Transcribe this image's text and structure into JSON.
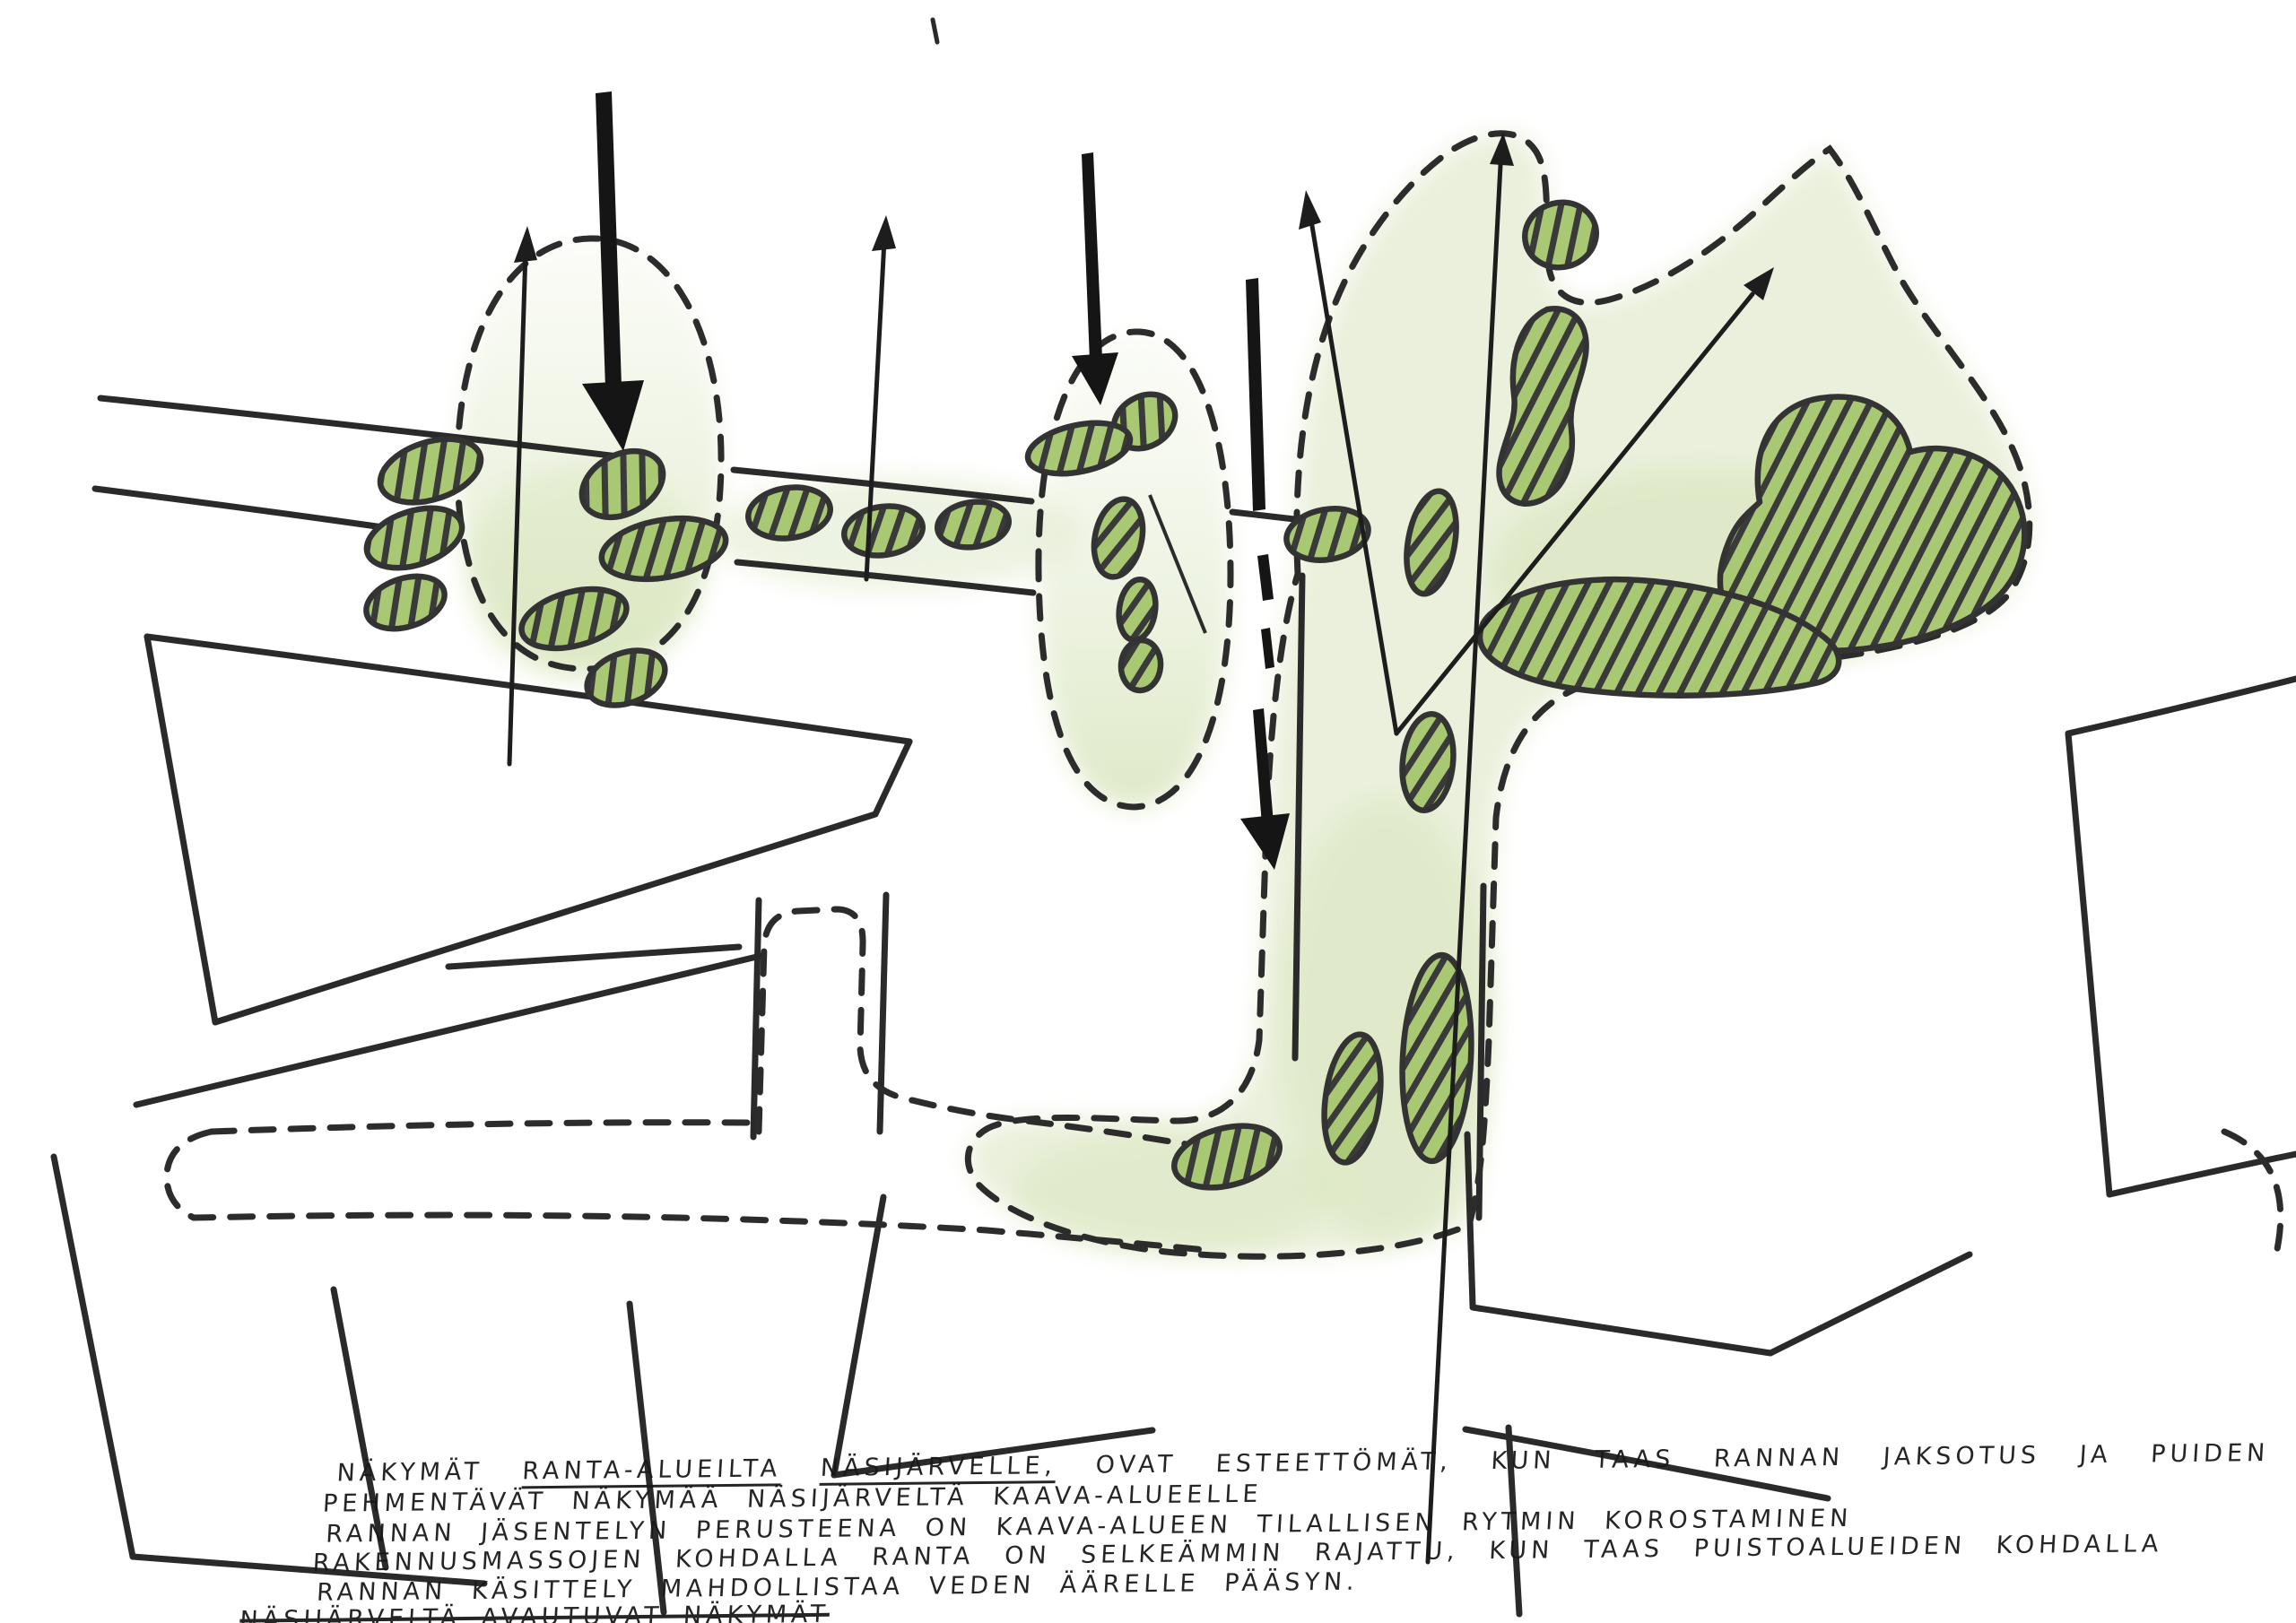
{
  "annotation": {
    "line1": {
      "lead": "NÄKYMÄT",
      "underlined1": "RANTA-ALUEILTA",
      "underlined2": "NÄSIJÄRVELLE,",
      "rest": "OVAT ESTEETTÖMÄT, KUN TAAS RANNAN JAKSOTUS JA PUIDEN RYHMITTELY"
    },
    "line2": "PEHMENTÄVÄT NÄKYMÄÄ NÄSIJÄRVELTÄ KAAVA-ALUEELLE",
    "line3": "RANNAN JÄSENTELYN PERUSTEENA ON KAAVA-ALUEEN TILALLISEN RYTMIN KOROSTAMINEN",
    "line4": "RAKENNUSMASSOJEN KOHDALLA RANTA ON SELKEÄMMIN RAJATTU, KUN TAAS PUISTOALUEIDEN KOHDALLA",
    "line5": "RANNAN KÄSITTELY MAHDOLLISTAA VEDEN ÄÄRELLE PÄÄSYN.",
    "line6_struck": "NÄSIJÄRVELTÄ AVAUTUVAT NÄKYMÄT"
  },
  "colors": {
    "paper": "#ffffff",
    "ink": "#2a2a2a",
    "text_ink": "#181818",
    "tree_green": "#a8c873",
    "hatch_line": "#3a3a3a",
    "wash_green": "#dce8c4",
    "wash_green_deep": "#d6e4b8"
  },
  "sketch_elements": {
    "tree_mass": "hatched-green-blob",
    "green_zone_boundary": "dashed-outline",
    "building_outline": "black-ink-line",
    "pedestrian_route": "dashed-street-band",
    "view_arrow": "thin-line-arrow",
    "access_arrow": "thick-solid-arrow"
  }
}
